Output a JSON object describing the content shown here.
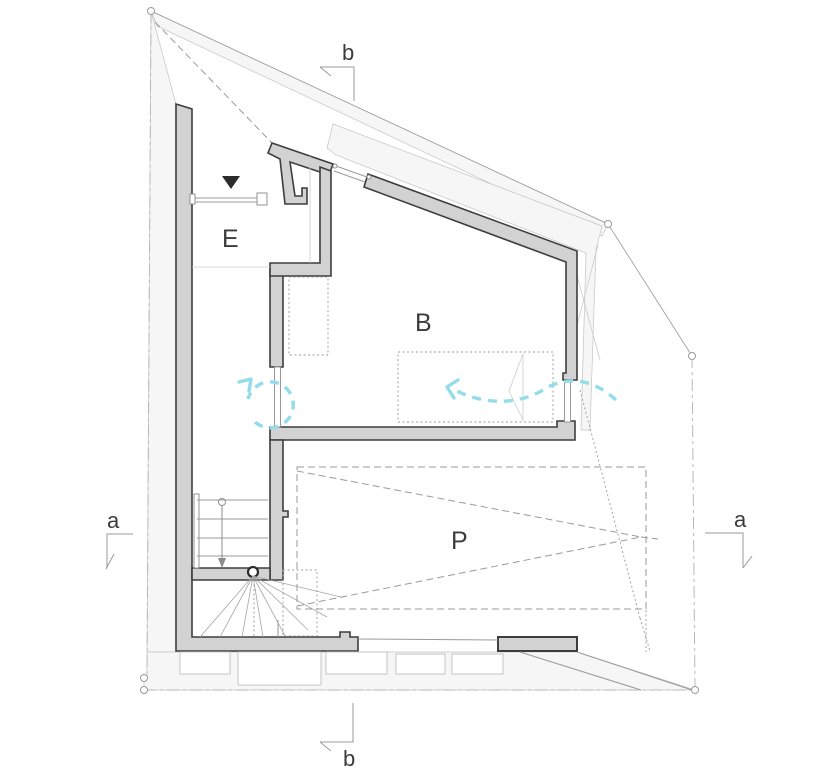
{
  "plan": {
    "kind": "architectural-floor-plan",
    "rooms": [
      {
        "label": "E"
      },
      {
        "label": "B"
      },
      {
        "label": "P"
      }
    ],
    "sections": [
      {
        "label": "b",
        "position": "top"
      },
      {
        "label": "b",
        "position": "bottom"
      },
      {
        "label": "a",
        "position": "left"
      },
      {
        "label": "a",
        "position": "right"
      }
    ],
    "icons": {
      "entrance": "entrance-triangle-icon",
      "stair": "stair-down-arrow-icon",
      "swirl": "circulation-swirl-arrow-icon",
      "breeze": "cross-ventilation-arrow-icon",
      "newel": "stair-newel-post-icon"
    }
  },
  "colors": {
    "wallFill": "#d2d2d2",
    "wallStroke": "#3d3d3d",
    "siteFill": "#f6f6f6",
    "faintLine": "#c4c4c4",
    "thinLine": "#9a9a9a",
    "lightLine": "#cccccc",
    "boundary": "#b8b8b8",
    "accentCyan": "#93dcea",
    "ink": "#3c3c3c",
    "markerBlack": "#2b2b2b"
  }
}
